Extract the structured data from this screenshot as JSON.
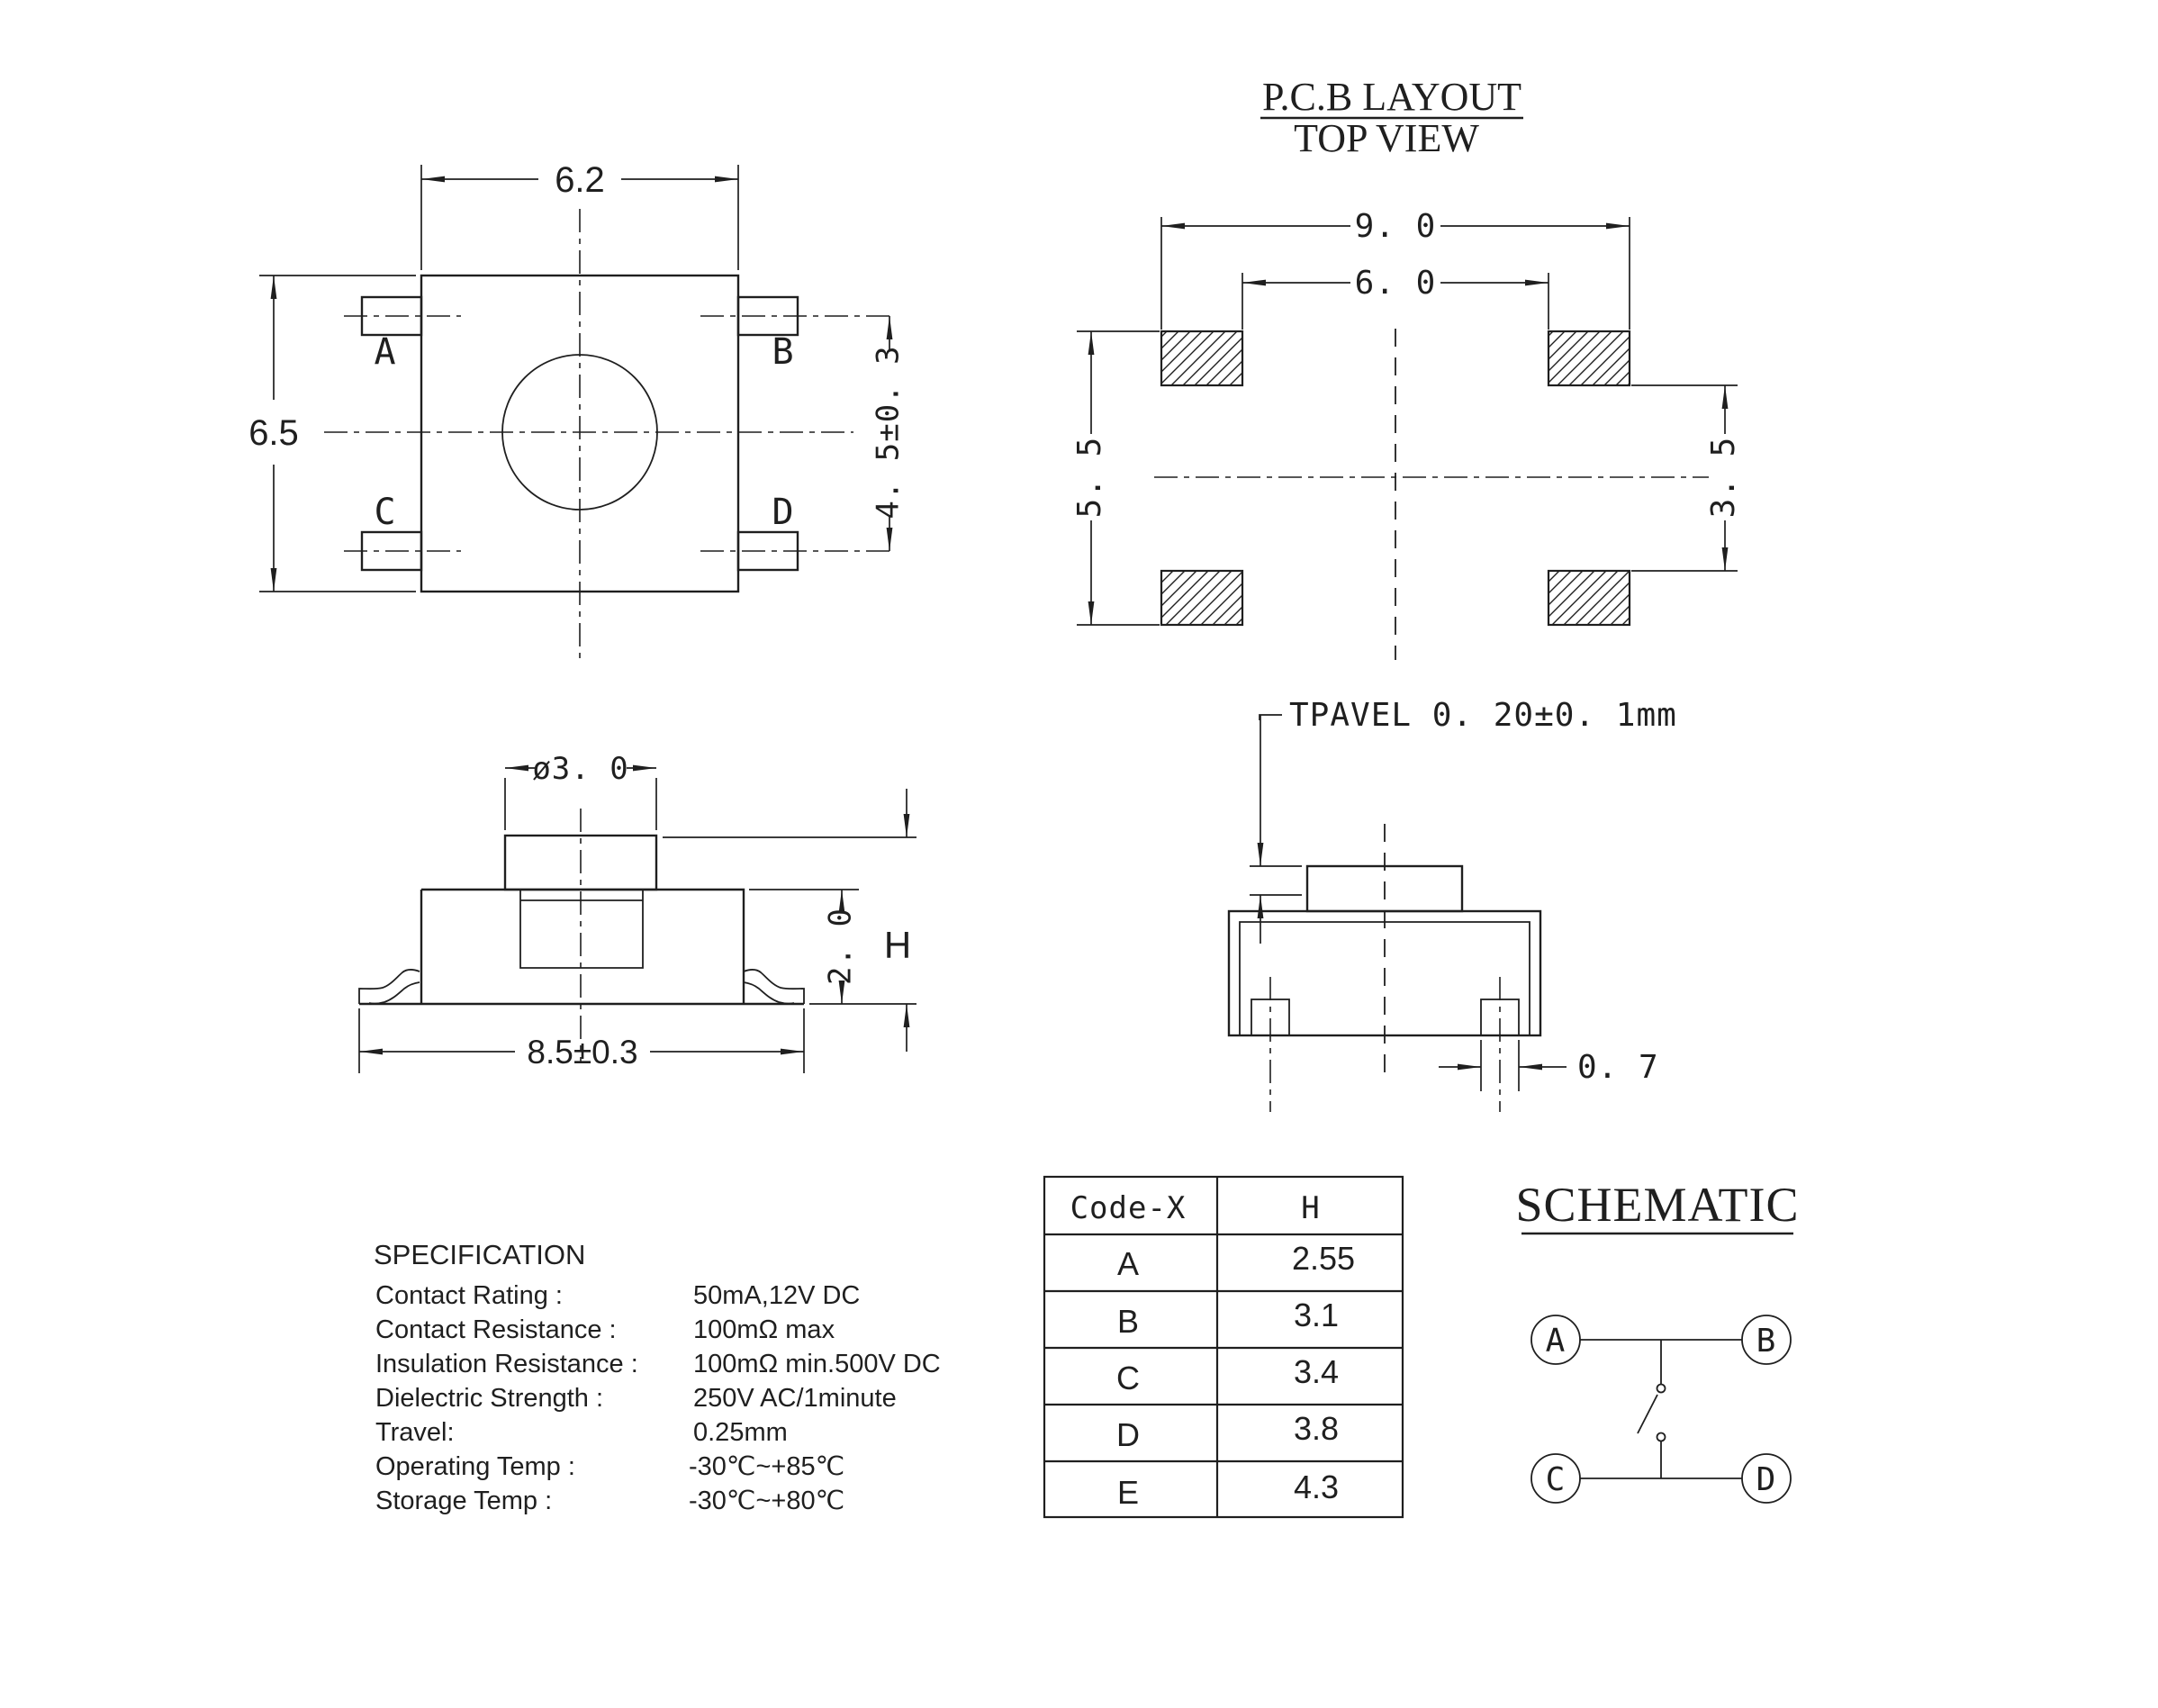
{
  "pcb_layout": {
    "title": "P.C.B LAYOUT",
    "subtitle": "TOP VIEW",
    "dim_outer_width": "9. 0",
    "dim_inner_width": "6. 0",
    "dim_left_height": "5. 5",
    "dim_right_height": "3. 5"
  },
  "top_view": {
    "dim_width": "6.2",
    "dim_height": "6.5",
    "dim_pin_span": "4. 5±0. 3",
    "pin_a": "A",
    "pin_b": "B",
    "pin_c": "C",
    "pin_d": "D"
  },
  "side_view": {
    "dim_button_dia": "ø3. 0",
    "dim_body_height": "2. 0",
    "dim_total_height": "H",
    "dim_foot_width": "8.5±0.3"
  },
  "travel_view": {
    "note": "TPAVEL 0. 20±0. 1mm",
    "dim_foot": "0. 7"
  },
  "specification": {
    "title": "SPECIFICATION",
    "rows": [
      {
        "label": "Contact Rating :",
        "value": "50mA,12V DC"
      },
      {
        "label": "Contact Resistance :",
        "value": "100mΩ max"
      },
      {
        "label": "Insulation Resistance :",
        "value": "100mΩ min.500V DC"
      },
      {
        "label": "Dielectric Strength :",
        "value": "250V AC/1minute"
      },
      {
        "label": "Travel:",
        "value": "0.25mm"
      },
      {
        "label": "Operating Temp :",
        "value": "-30℃~+85℃"
      },
      {
        "label": "Storage Temp :",
        "value": "-30℃~+80℃"
      }
    ]
  },
  "code_table": {
    "col1_header": "Code-X",
    "col2_header": "H",
    "rows": [
      {
        "code": "A",
        "h": "2.55"
      },
      {
        "code": "B",
        "h": "3.1"
      },
      {
        "code": "C",
        "h": "3.4"
      },
      {
        "code": "D",
        "h": "3.8"
      },
      {
        "code": "E",
        "h": "4.3"
      }
    ]
  },
  "schematic": {
    "title": "SCHEMATIC",
    "t1": "A",
    "t2": "B",
    "t3": "C",
    "t4": "D"
  }
}
